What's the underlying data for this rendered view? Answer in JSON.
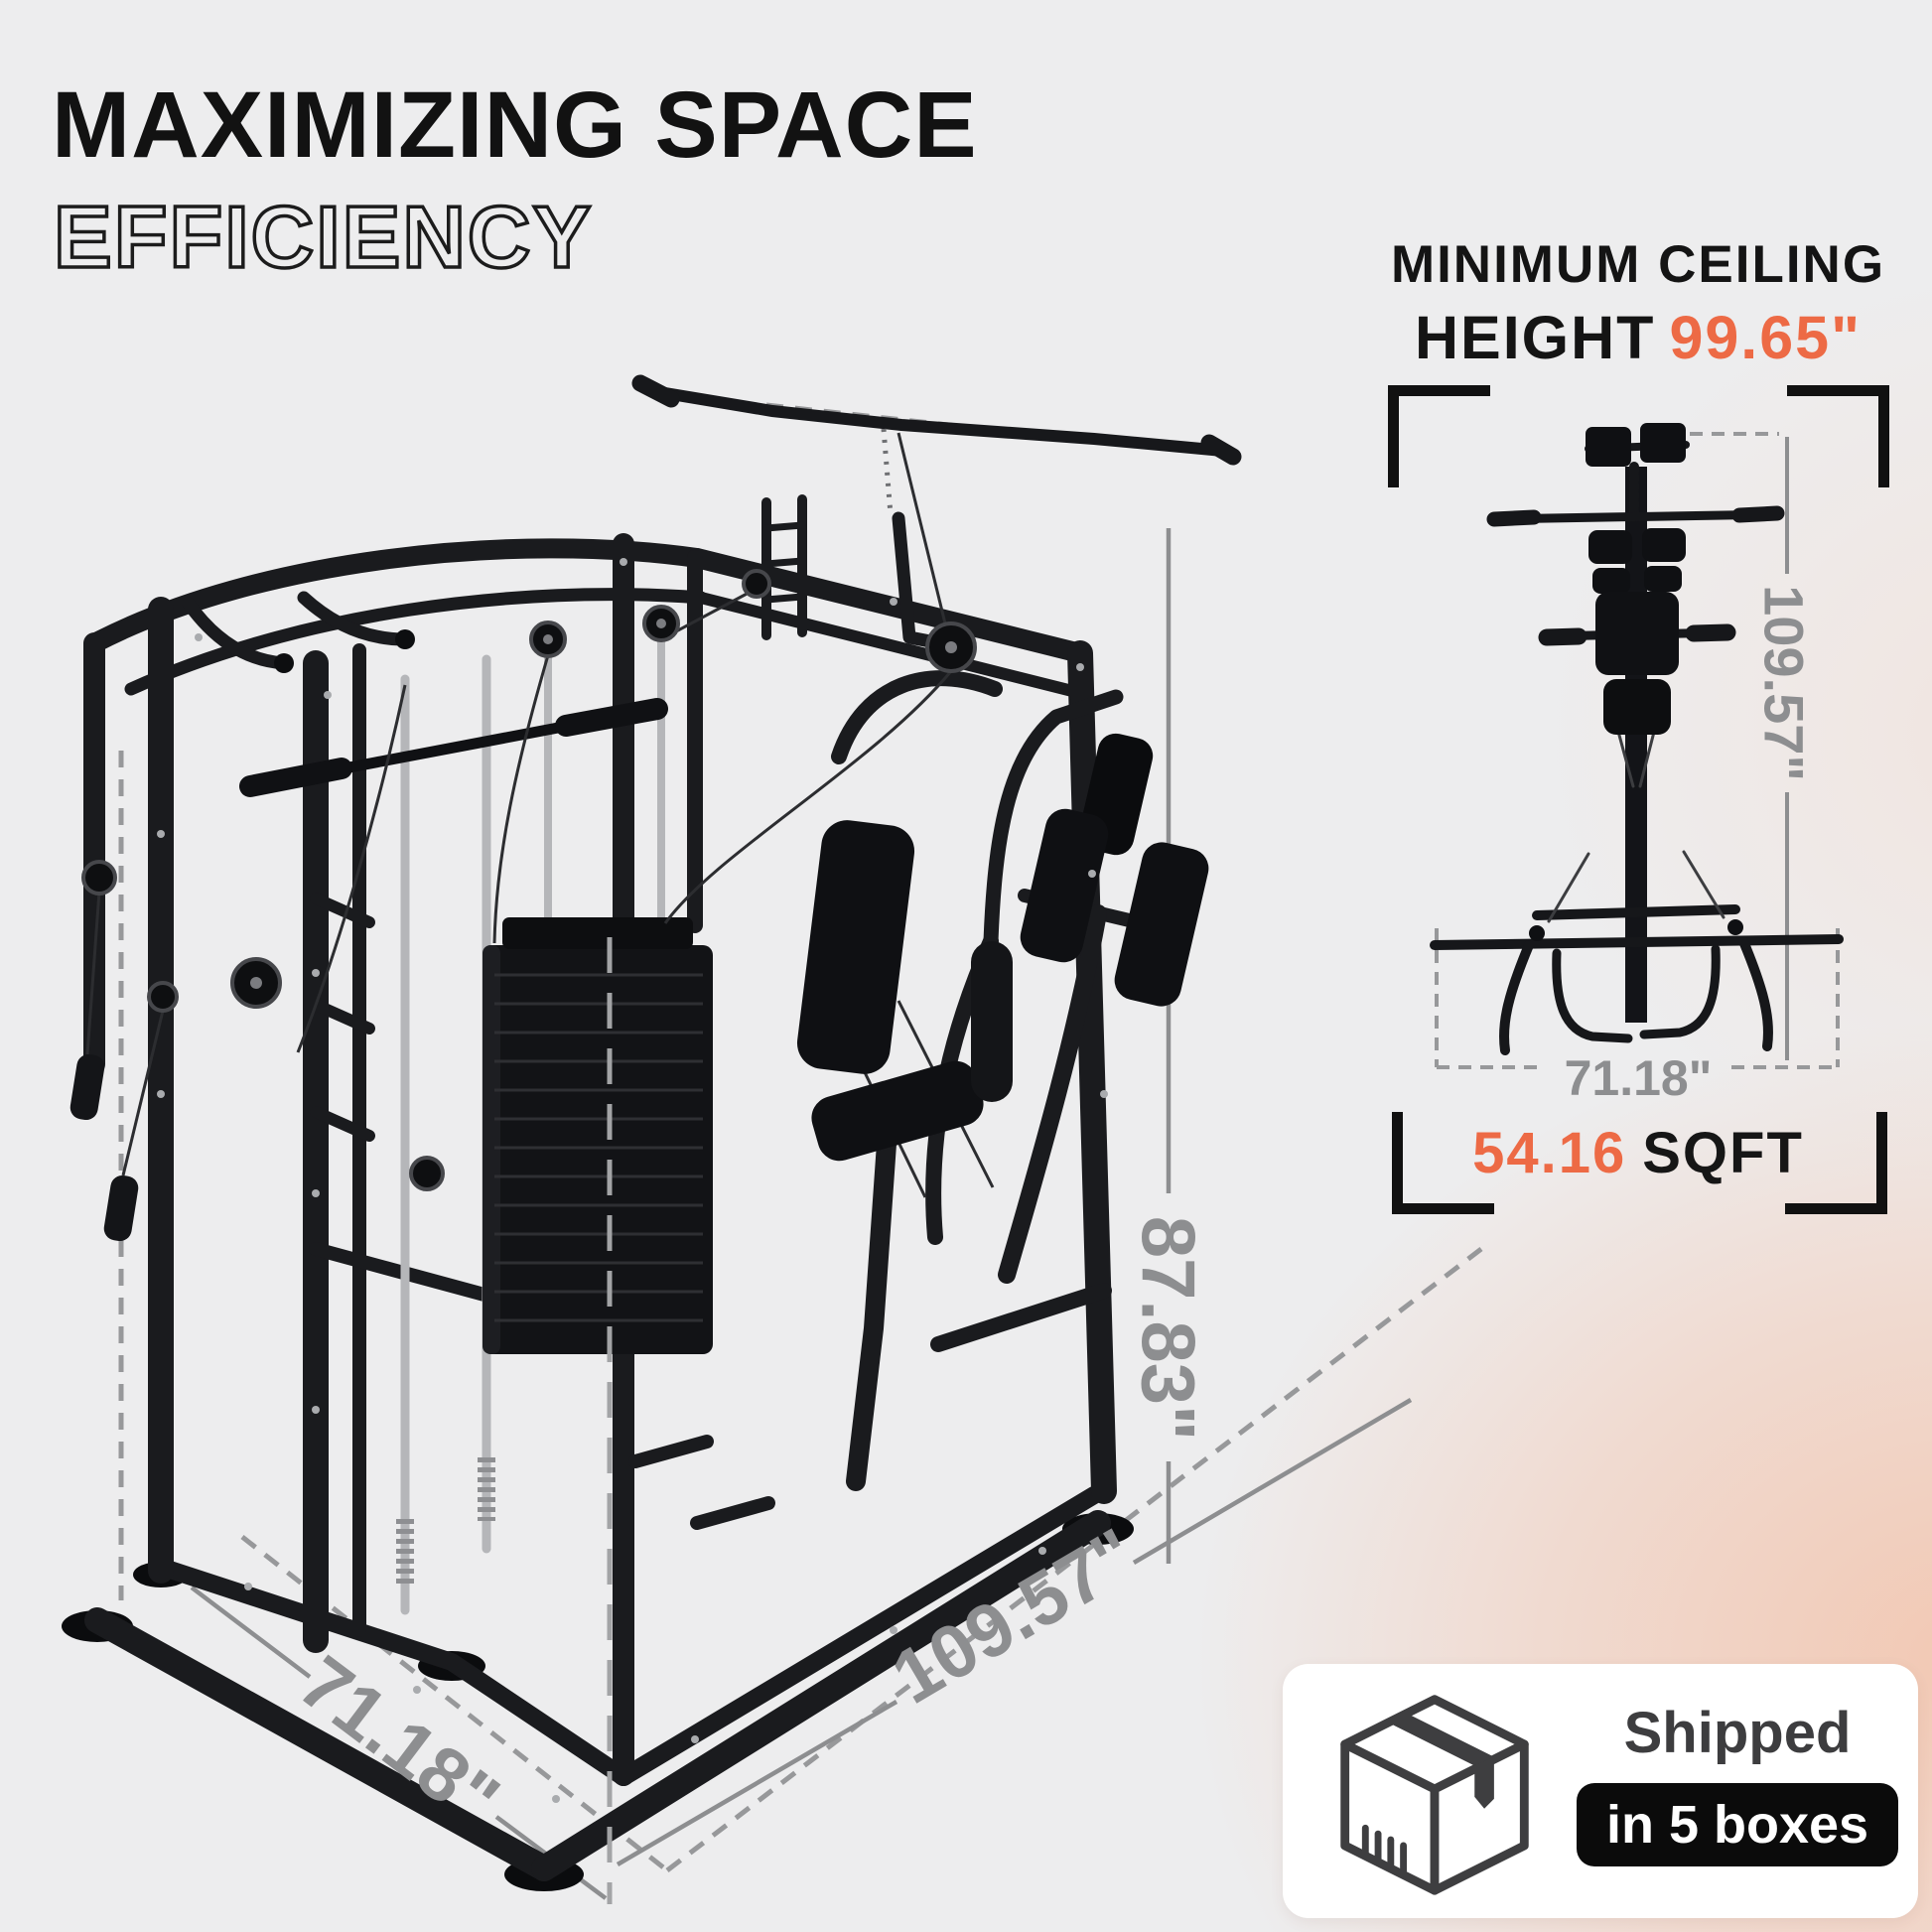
{
  "title": {
    "line1": "MAXIMIZING SPACE",
    "line2": "EFFICIENCY"
  },
  "ceiling_note": {
    "line1": "MINIMUM CEILING",
    "line2_label": "HEIGHT",
    "line2_value": "99.65\""
  },
  "top_view": {
    "height_dim": "109.57\"",
    "width_dim": "71.18\"",
    "area_value": "54.16",
    "area_unit": "SQFT"
  },
  "main_view": {
    "height_dim": "87.83\"",
    "depth_dim": "109.57\"",
    "width_dim": "71.18\""
  },
  "shipping": {
    "label": "Shipped",
    "badge": "in 5 boxes"
  },
  "icons": {
    "box": "shipping-box-icon",
    "machine_main": "gym-machine-isometric-illustration",
    "machine_top": "gym-machine-top-view-illustration"
  },
  "colors": {
    "accent_orange": "#ed6a45",
    "dimension_gray": "#8d8e90",
    "ink": "#121212",
    "background": "#ededee",
    "blush": "#f2c6b0",
    "machine_black": "#1a1b1e",
    "chrome": "#b5b6b9"
  }
}
